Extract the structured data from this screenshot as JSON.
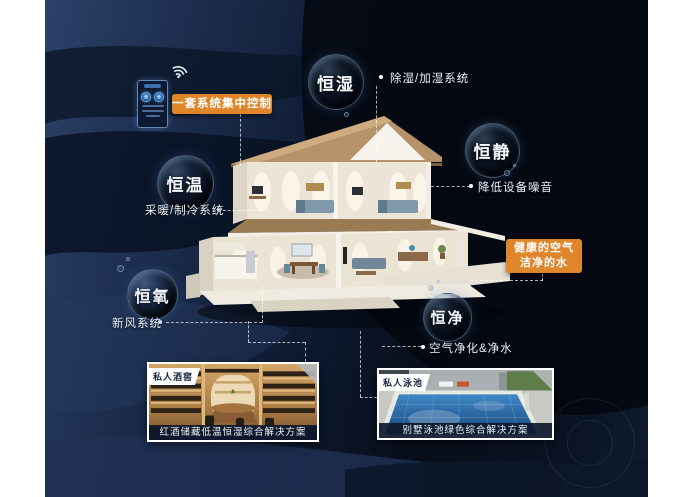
{
  "control_box": {
    "label": "一套系统集中控制"
  },
  "health_box": {
    "line1": "健康的空气",
    "line2": "洁净的水"
  },
  "bubbles": [
    {
      "label": "恒湿",
      "note": "除湿/加湿系统"
    },
    {
      "label": "恒静",
      "note": "降低设备噪音"
    },
    {
      "label": "恒温",
      "note": "采暖/制冷系统"
    },
    {
      "label": "恒氧",
      "note": "新风系统"
    },
    {
      "label": "恒净",
      "note": "空气净化&净水"
    }
  ],
  "photos": [
    {
      "tag": "私人酒窖",
      "caption": "红酒储藏低温恒湿综合解决方案"
    },
    {
      "tag": "私人泳池",
      "caption": "别墅泳池绿色综合解决方案"
    }
  ],
  "colors": {
    "accent_orange": "#e0862a",
    "panel_navy": "#101d36",
    "bubble_ring": "#96b9e1"
  }
}
